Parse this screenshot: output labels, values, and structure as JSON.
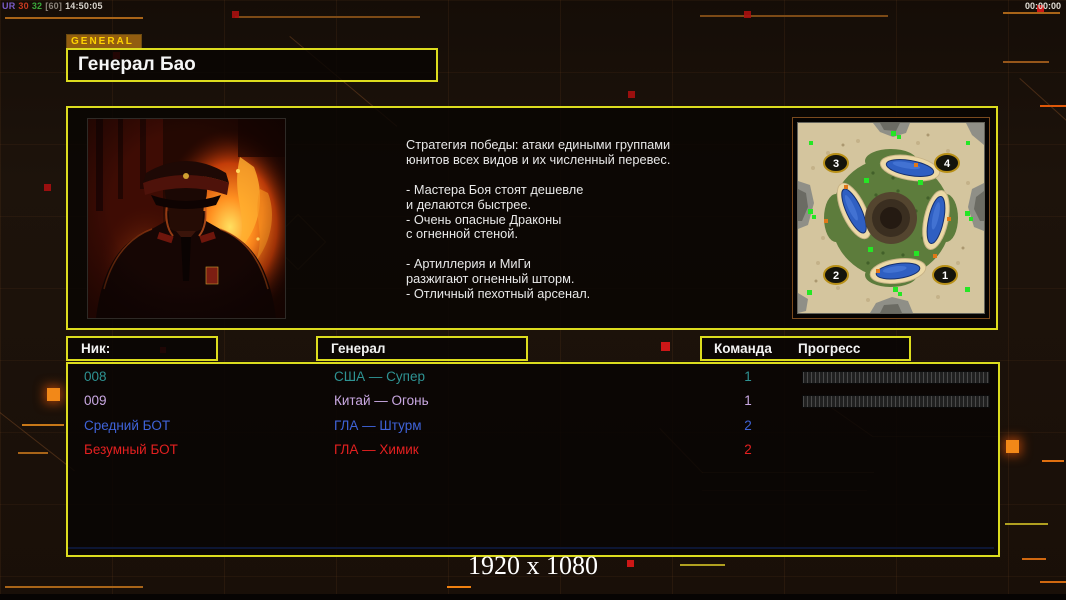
{
  "topbar": {
    "stats": [
      {
        "text": "UR",
        "color": "#7b5cc8"
      },
      {
        "text": "30",
        "color": "#c83a20"
      },
      {
        "text": "32",
        "color": "#3aa83a"
      },
      {
        "text": "[60]",
        "color": "#8a8278"
      },
      {
        "text": "14:50:05",
        "color": "#d8d4cc"
      }
    ],
    "clock": "00:00:00"
  },
  "general_panel": {
    "tab_label": "GENERAL",
    "name": "Генерал Бао",
    "strategy_text": "Стратегия победы: атаки едиными группами\nюнитов всех видов и их численный перевес.\n\n- Мастера Боя стоят дешевле\nи делаются быстрее.\n- Очень опасные Драконы\nс огненной стеной.\n\n- Артиллерия и МиГи\nразжигают огненный шторм.\n- Отличный пехотный арсенал."
  },
  "map": {
    "badges": [
      {
        "label": "3"
      },
      {
        "label": "4"
      },
      {
        "label": "2"
      },
      {
        "label": "1"
      }
    ]
  },
  "table": {
    "headers": {
      "nick": "Ник:",
      "general": "Генерал",
      "team": "Команда",
      "progress": "Прогресс"
    },
    "rows": [
      {
        "nick": "008",
        "general": "США — Супер",
        "team": "1",
        "color": "#2e9393",
        "progress": true
      },
      {
        "nick": "009",
        "general": "Китай — Огонь",
        "team": "1",
        "color": "#c9a8e2",
        "progress": true
      },
      {
        "nick": "Средний БОТ",
        "general": "ГЛА — Штурм",
        "team": "2",
        "color": "#3f63d8",
        "progress": false
      },
      {
        "nick": "Безумный БОТ",
        "general": "ГЛА — Химик",
        "team": "2",
        "color": "#e32020",
        "progress": false
      }
    ]
  },
  "footer": {
    "resolution_label": "1920 x 1080"
  },
  "colors": {
    "panel_border": "#dcdc1e",
    "tab_bg": "#925d10",
    "tab_text": "#ffd200",
    "background": "#1a110a",
    "progress_bar_bg": "#202020"
  }
}
